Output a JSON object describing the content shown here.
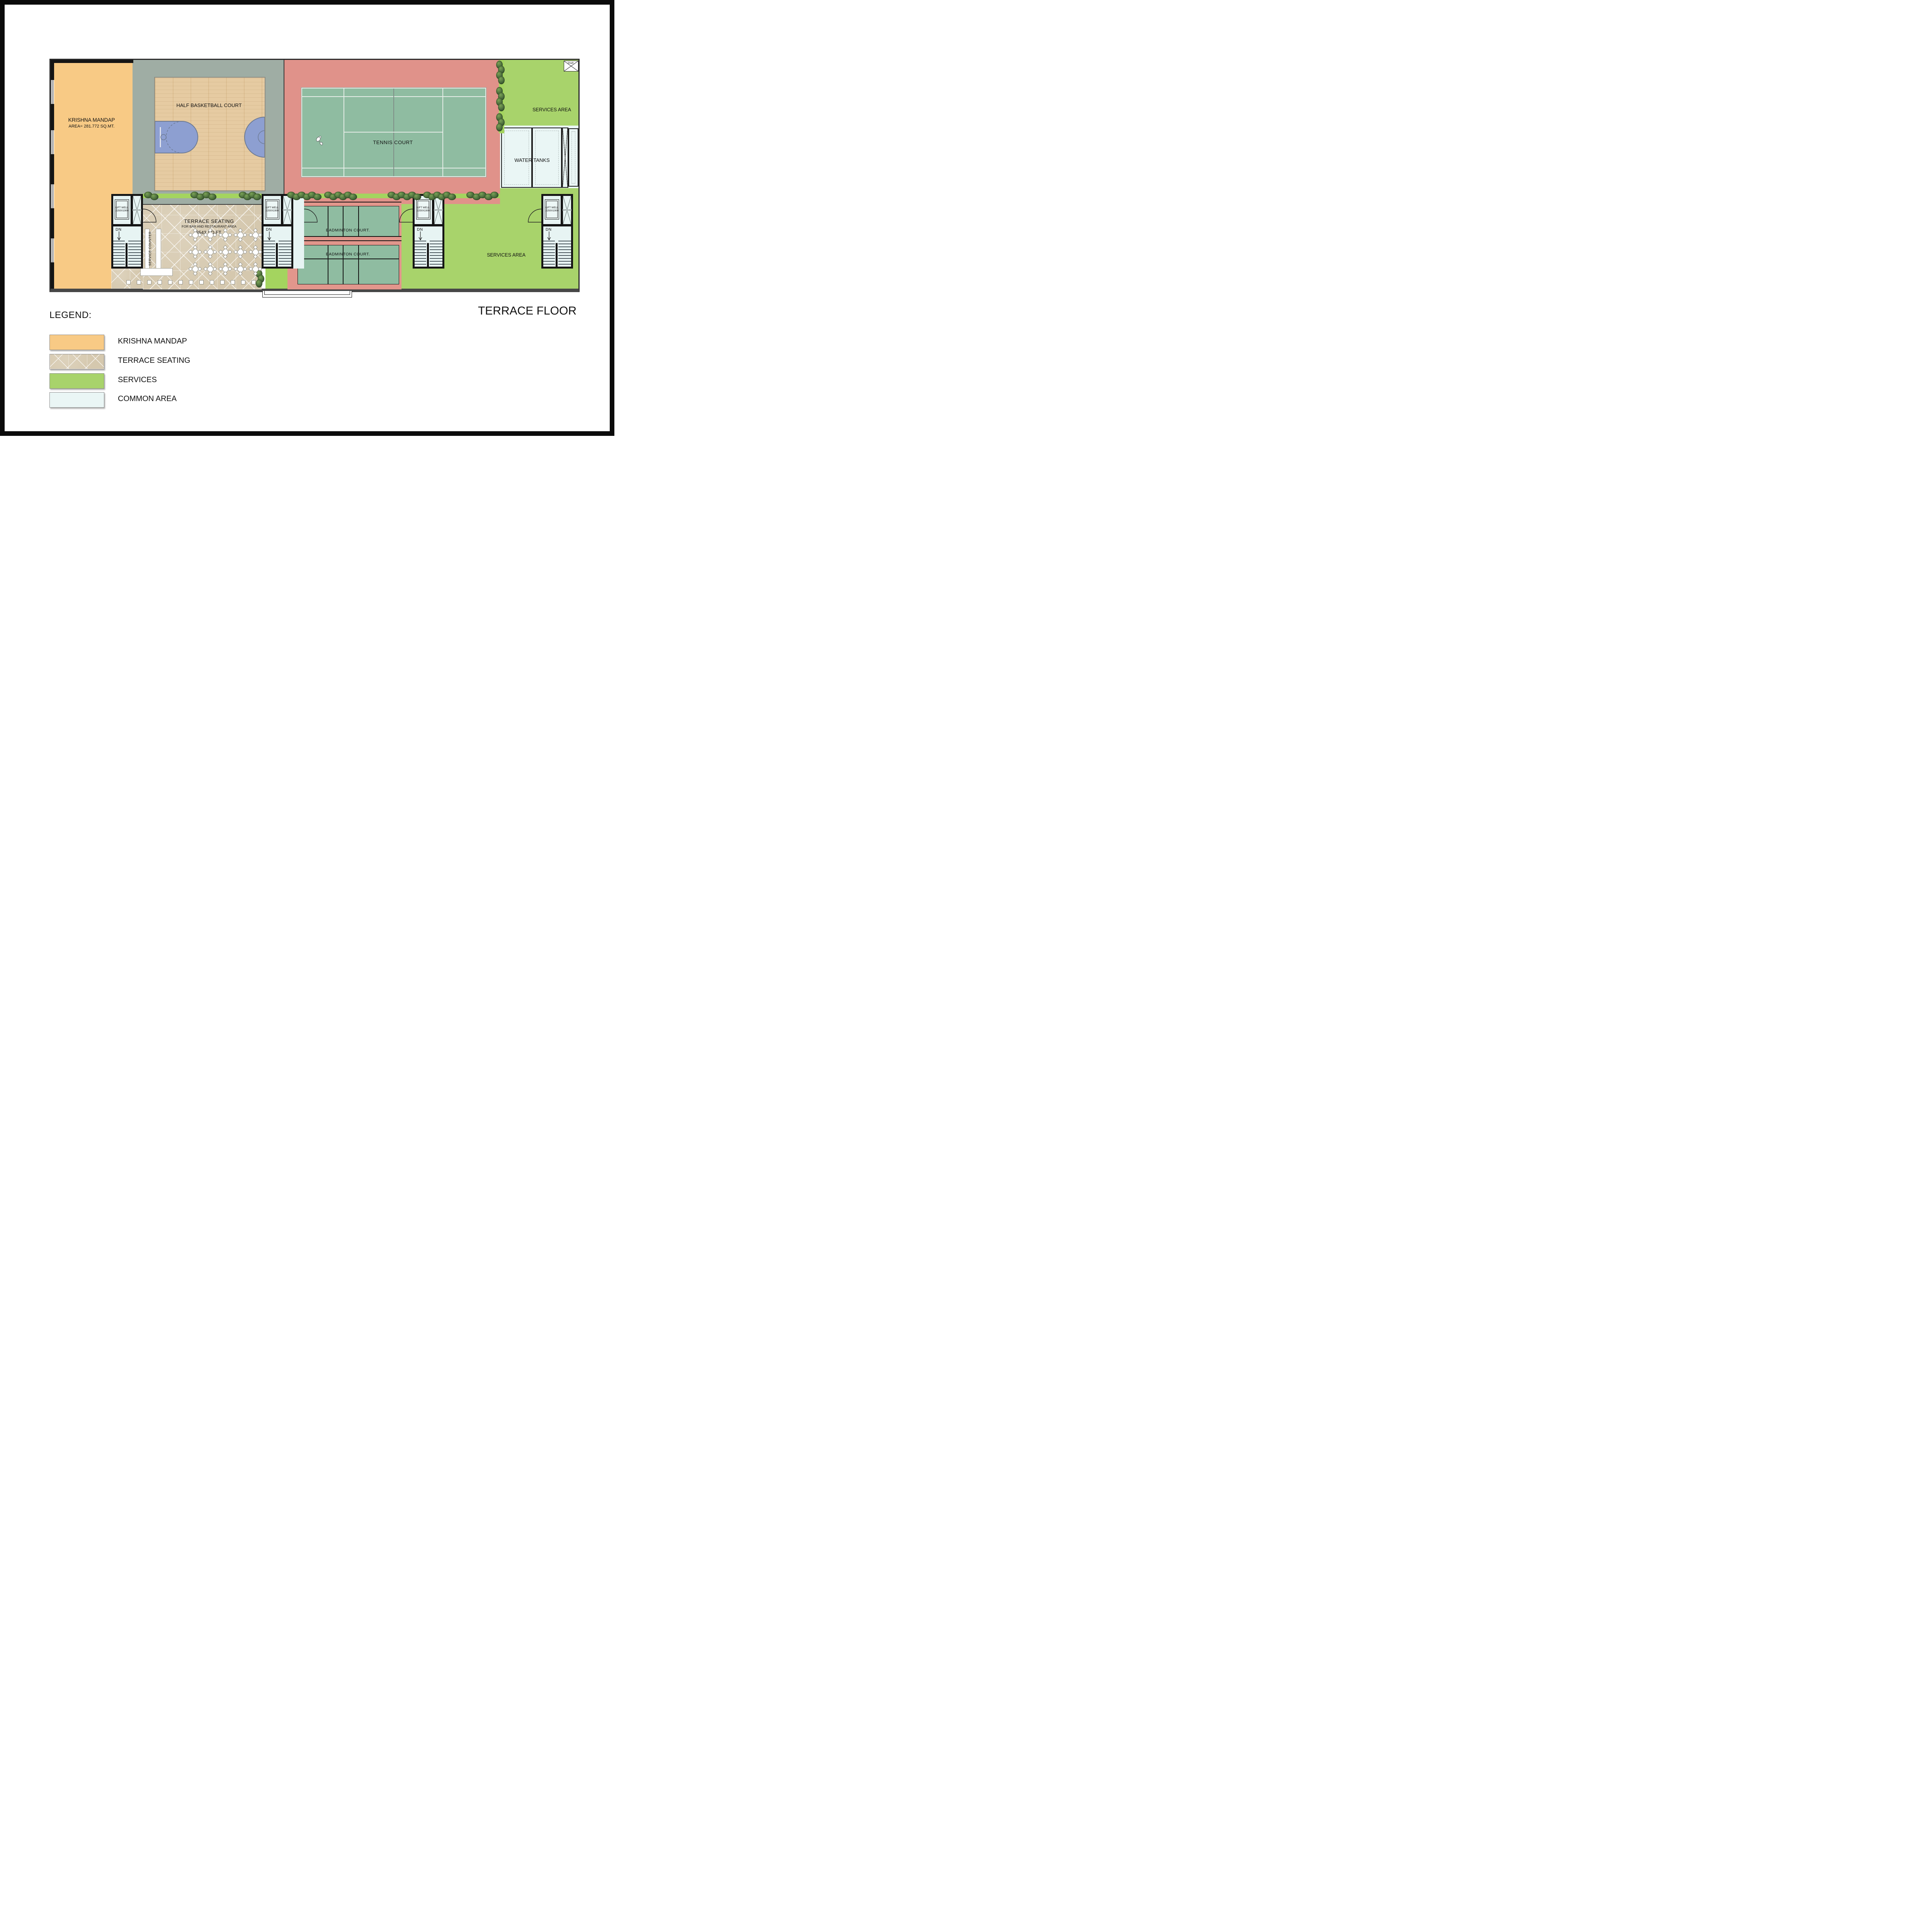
{
  "title": "TERRACE FLOOR",
  "legend": {
    "title": "LEGEND:",
    "items": [
      {
        "label": "KRISHNA MANDAP",
        "swatch": "krishna-mandap-color",
        "color": "#F8CA85"
      },
      {
        "label": "TERRACE SEATING",
        "swatch": "terrace-tile-pattern",
        "color": "#D9CDB5"
      },
      {
        "label": "SERVICES",
        "swatch": "services-color",
        "color": "#A8D36B"
      },
      {
        "label": "COMMON AREA",
        "swatch": "common-area-color",
        "color": "#EAF6F5"
      }
    ]
  },
  "plan": {
    "krishna_mandap": {
      "name": "KRISHNA MANDAP",
      "area": "AREA= 281.772 SQ.MT."
    },
    "basketball": {
      "label": "HALF BASKETBALL COURT"
    },
    "tennis": {
      "label": "TENNIS COURT"
    },
    "badminton": {
      "court1_label": "BADMINTON COURT.",
      "court2_label": "BADMINTON COURT."
    },
    "terrace_seating": {
      "title": "TERRACE  SEATING",
      "subtitle": "FOR BAR AND RESTAURANT AREA",
      "area": "3543 SQ.FT."
    },
    "service_counter": {
      "label": "SERVICE COUNTER"
    },
    "services_top": {
      "label": "SERVICES AREA"
    },
    "services_right": {
      "label": "SERVICES AREA"
    },
    "water_tanks": {
      "label": "WATER TANKS"
    },
    "shaft": {
      "label": "Shaft"
    },
    "core": {
      "lift1": "LIFT WELL",
      "lift2": "2250X1900",
      "services": "SERVICES",
      "dn": "DN"
    }
  },
  "colors": {
    "krishna_orange": "#F8CA85",
    "services_green": "#A8D36B",
    "common_light_blue": "#E7F4F3",
    "court_green": "#8FBCA1",
    "sport_pink": "#E0928A",
    "wood": "#E6CBA2",
    "deck_gray": "#9FADA4",
    "planter_green": "#A4D45F"
  }
}
